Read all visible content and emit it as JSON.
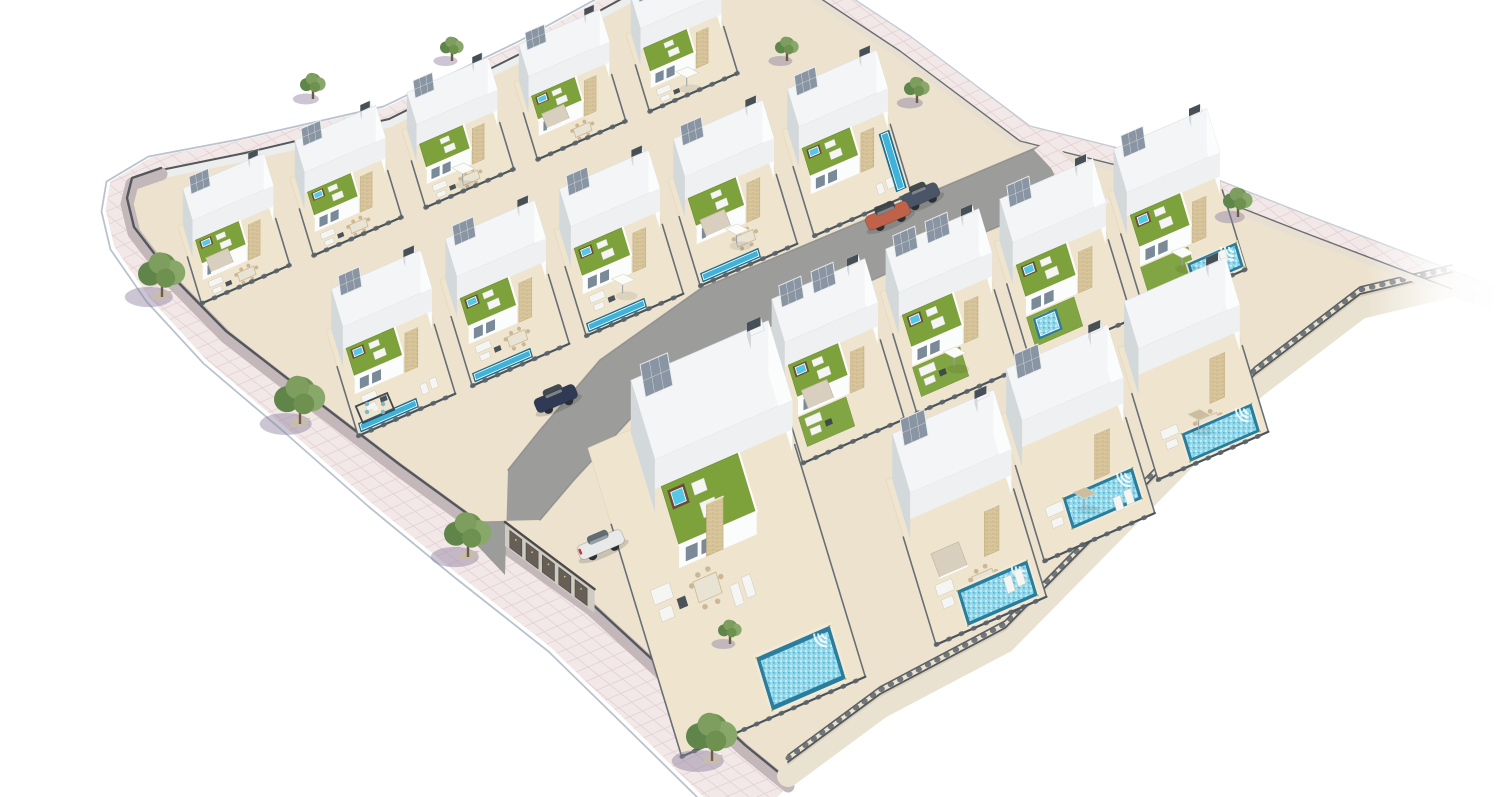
{
  "meta": {
    "scene_type": "aerial 3D architectural render of a residential villa development with rooftop gardens and pools"
  },
  "palette": {
    "bg": "#ffffff",
    "sidewalk": "#f3e8e8",
    "sidewalkLine": "#dcc6cb",
    "sidewalkEdge": "#b9c3cd",
    "curb": "#ffffff",
    "siteBase": "#ece2cd",
    "wallPink": "#c3b7ba",
    "wallWhite": "#eceded",
    "wallCream": "#eae2d0",
    "wallCap": "#54585c",
    "road": "#9c9c9a",
    "roadEdge": "#8a8a88",
    "plot": "#efe5cf",
    "plotLine": "#e2d6ba",
    "roof": "#f3f5f6",
    "faceBright": "#fbfcfc",
    "faceLight": "#eef0f1",
    "faceShade": "#d3d8db",
    "faceDark": "#c6cbcf",
    "glass": "#7a8a98",
    "door": "#5e6569",
    "stone": "#d8c69c",
    "stoneLine": "#c2aa7c",
    "grass": "#7da23c",
    "grassDark": "#688c2f",
    "jacuzziDeck": "#6a4e37",
    "jacuzziWater": "#56c8e6",
    "poolRim": "#2a7d9c",
    "poolWater": "#8fd6e8",
    "lapWater": "#3fb2d9",
    "lapRim": "#1e6e8e",
    "poolLight": "#c9a84c",
    "fence": "#4a545c",
    "fence2": "#5a636b",
    "solar": "#8a95a3",
    "solarFrame": "#e9edf0",
    "awning": "#d9cfbf",
    "awningEdge": "#c4b8a4",
    "furnWhite": "#f5f5f3",
    "furnBeige": "#cbb795",
    "furnDark": "#39434b",
    "cushTeal": "#7fb4c9",
    "treeA": "#7d9e5f",
    "treeB": "#6e9150",
    "treeC": "#87a869",
    "treeD": "#5f854a",
    "trunk": "#6d5b45",
    "treeShadow": "#8c7fa0",
    "treeBase": "#c9bdab",
    "carOrange": "#c0614a",
    "carBlue": "#2f3a55",
    "carWhite": "#e8e9e9",
    "carGray": "#4a5568",
    "carGlass": "#3a4148",
    "tailLight": "#c03b30",
    "garageWall": "#cfcac2",
    "garageDoor": "#665f58",
    "garageDoorEdge": "#4e4a45"
  },
  "scene": {
    "canvas": {
      "width": 1500,
      "height": 797
    },
    "axes": {
      "u": [
        0.92,
        -0.4
      ],
      "v": [
        0.29,
        0.955
      ]
    },
    "sidewalk_left_outer": [
      [
        648,
        -30
      ],
      [
        520,
        40
      ],
      [
        385,
        105
      ],
      [
        240,
        138
      ],
      [
        150,
        155
      ],
      [
        108,
        180
      ],
      [
        103,
        210
      ],
      [
        112,
        248
      ],
      [
        148,
        300
      ],
      [
        205,
        362
      ],
      [
        285,
        430
      ],
      [
        370,
        505
      ],
      [
        455,
        575
      ],
      [
        550,
        650
      ],
      [
        635,
        733
      ],
      [
        700,
        797
      ],
      [
        742,
        834
      ]
    ],
    "sidewalk_left_inner": [
      [
        656,
        -16
      ],
      [
        528,
        54
      ],
      [
        389,
        123
      ],
      [
        245,
        157
      ],
      [
        161,
        174
      ],
      [
        132,
        184
      ],
      [
        127,
        204
      ],
      [
        134,
        233
      ],
      [
        170,
        280
      ],
      [
        226,
        337
      ],
      [
        310,
        402
      ],
      [
        399,
        470
      ],
      [
        487,
        534
      ],
      [
        591,
        609
      ],
      [
        678,
        689
      ],
      [
        745,
        751
      ],
      [
        788,
        786
      ]
    ],
    "bottomright_wall": [
      [
        788,
        786
      ],
      [
        880,
        718
      ],
      [
        1005,
        652
      ],
      [
        1130,
        525
      ],
      [
        1255,
        398
      ],
      [
        1360,
        318
      ],
      [
        1452,
        296
      ]
    ],
    "topright_edge": [
      [
        770,
        -28
      ],
      [
        900,
        58
      ],
      [
        1020,
        148
      ],
      [
        1160,
        183
      ],
      [
        1300,
        238
      ],
      [
        1452,
        296
      ],
      [
        1540,
        330
      ]
    ],
    "topright_sidewalk_offset": [
      10,
      -22
    ],
    "road_upper": [
      [
        1040,
        146
      ],
      [
        860,
        222
      ],
      [
        700,
        289
      ],
      [
        600,
        360
      ],
      [
        540,
        430
      ],
      [
        508,
        470
      ]
    ],
    "road_lower": [
      [
        1066,
        198
      ],
      [
        886,
        274
      ],
      [
        731,
        344
      ],
      [
        634,
        415
      ],
      [
        574,
        480
      ],
      [
        540,
        520
      ]
    ],
    "road_mouth": [
      [
        508,
        470
      ],
      [
        540,
        520
      ],
      [
        505,
        575
      ],
      [
        455,
        522
      ]
    ],
    "crosswalk": [
      [
        1034,
        150
      ],
      [
        1094,
        214
      ],
      [
        1110,
        202
      ],
      [
        1050,
        138
      ]
    ],
    "garages": {
      "start": [
        505,
        546
      ],
      "dir": [
        0.8,
        0.6
      ],
      "length": 112,
      "doors": 5,
      "doorW": 15,
      "doorH": 17,
      "wallH": 24
    },
    "pergola": {
      "x": 375,
      "y": 408
    },
    "villas": [
      {
        "id": "A1",
        "o": [
          178,
          226
        ],
        "s": 0.8,
        "vs": 0.78,
        "d": 130,
        "f": [
          "awning",
          "dining",
          "sofa",
          "roofGarden",
          "jacuzzi",
          "solar",
          "stone"
        ]
      },
      {
        "id": "A2",
        "o": [
          290,
          178
        ],
        "s": 0.8,
        "vs": 0.78,
        "d": 130,
        "f": [
          "roofGarden",
          "jacuzzi",
          "solar",
          "stone",
          "sofa",
          "dining"
        ]
      },
      {
        "id": "A3",
        "o": [
          402,
          130
        ],
        "s": 0.8,
        "vs": 0.78,
        "d": 130,
        "f": [
          "umbrella",
          "roofGarden",
          "solar",
          "stone",
          "sofa",
          "dining"
        ]
      },
      {
        "id": "A4",
        "o": [
          514,
          82
        ],
        "s": 0.8,
        "vs": 0.78,
        "d": 130,
        "f": [
          "awning",
          "roofGarden",
          "jacuzzi",
          "solar",
          "stone",
          "dining"
        ]
      },
      {
        "id": "A5",
        "o": [
          626,
          34
        ],
        "s": 0.8,
        "vs": 0.78,
        "d": 130,
        "f": [
          "umbrella",
          "roofGarden",
          "solar",
          "stone",
          "sofa"
        ]
      },
      {
        "id": "B1",
        "o": [
          326,
          330
        ],
        "s": 0.88,
        "vs": 0.84,
        "f": [
          "roofGarden",
          "jacuzzi",
          "solar",
          "stone",
          "lapPoolU",
          "sofa",
          "loungers"
        ]
      },
      {
        "id": "B2",
        "o": [
          440,
          280
        ],
        "s": 0.88,
        "vs": 0.84,
        "f": [
          "roofGarden",
          "jacuzzi",
          "solar",
          "stone",
          "lapPoolU",
          "sofa",
          "dining"
        ]
      },
      {
        "id": "B3",
        "o": [
          554,
          230
        ],
        "s": 0.88,
        "vs": 0.84,
        "f": [
          "umbrella",
          "roofGarden",
          "jacuzzi",
          "solar",
          "stone",
          "lapPoolU",
          "sofa"
        ]
      },
      {
        "id": "B4",
        "o": [
          668,
          180
        ],
        "s": 0.88,
        "vs": 0.84,
        "f": [
          "awning",
          "umbrella",
          "roofGarden",
          "solar",
          "stone",
          "lapPoolU",
          "dining"
        ]
      },
      {
        "id": "B5",
        "o": [
          782,
          130
        ],
        "s": 0.88,
        "vs": 0.84,
        "f": [
          "roofGarden",
          "jacuzzi",
          "solar",
          "stone",
          "lapPoolV",
          "loungers"
        ]
      },
      {
        "id": "D1",
        "o": [
          766,
          342
        ],
        "s": 0.92,
        "vs": 0.92,
        "f": [
          "solar2",
          "roofGarden",
          "jacuzzi",
          "stone",
          "grass",
          "sofa",
          "awning"
        ]
      },
      {
        "id": "D2",
        "o": [
          880,
          292
        ],
        "s": 0.92,
        "vs": 0.92,
        "f": [
          "solar2",
          "roofGarden",
          "jacuzzi",
          "stone",
          "grass",
          "umbrella",
          "sofa"
        ]
      },
      {
        "id": "D3",
        "o": [
          994,
          242
        ],
        "s": 0.92,
        "vs": 0.92,
        "f": [
          "solar",
          "roofGarden",
          "jacuzzi",
          "stone",
          "grass",
          "smallPool",
          "sofa"
        ]
      },
      {
        "id": "D4",
        "o": [
          1108,
          192
        ],
        "s": 0.92,
        "vs": 0.92,
        "f": [
          "solar",
          "roofGarden",
          "jacuzzi",
          "stone",
          "grass",
          "umbrella",
          "bigPool",
          "loungers"
        ],
        "pool": [
          60,
          116,
          118,
          146
        ]
      },
      {
        "id": "E3",
        "o": [
          1118,
          348
        ],
        "s": 1.0,
        "vs": 0.92,
        "f": [
          "bigPool",
          "dining",
          "sofa",
          "stone",
          "umbrellaTan"
        ]
      },
      {
        "id": "E2",
        "o": [
          1000,
          415
        ],
        "s": 1.0,
        "vs": 1.02,
        "f": [
          "bigPool",
          "sofa",
          "loungers",
          "stone",
          "umbrellaTan",
          "solar"
        ],
        "pool": [
          36,
          100,
          112,
          132
        ]
      },
      {
        "id": "C0",
        "o": [
          588,
          448
        ],
        "s": 1.14,
        "vs": 1.35,
        "w": 175,
        "d": 210,
        "f": [
          "roofGardenBig",
          "jacuzzi",
          "solar",
          "stone",
          "bigPool",
          "dining",
          "sofa",
          "loungers"
        ],
        "pool": [
          88,
          170,
          158,
          206
        ]
      },
      {
        "id": "E1",
        "o": [
          886,
          480
        ],
        "s": 1.0,
        "vs": 1.15,
        "f": [
          "bigPool",
          "sofa",
          "dining",
          "loungers",
          "stone",
          "awning",
          "solar"
        ]
      }
    ],
    "trees": [
      {
        "x": 162,
        "y": 293,
        "r": 24,
        "street": true
      },
      {
        "x": 300,
        "y": 420,
        "r": 26,
        "street": true
      },
      {
        "x": 468,
        "y": 553,
        "r": 24,
        "street": true
      },
      {
        "x": 712,
        "y": 757,
        "r": 26,
        "street": true
      },
      {
        "x": 313,
        "y": 95,
        "r": 13
      },
      {
        "x": 452,
        "y": 57,
        "r": 12
      },
      {
        "x": 787,
        "y": 57,
        "r": 12
      },
      {
        "x": 917,
        "y": 99,
        "r": 13
      },
      {
        "x": 1238,
        "y": 213,
        "r": 15
      },
      {
        "x": 730,
        "y": 640,
        "r": 12
      }
    ],
    "cars": [
      {
        "name": "car-gray",
        "x": 921,
        "y": 196,
        "len": 38,
        "color": "carGray",
        "angle": -23
      },
      {
        "name": "car-orange",
        "x": 888,
        "y": 216,
        "len": 46,
        "color": "carOrange",
        "angle": -23
      },
      {
        "name": "car-blue",
        "x": 556,
        "y": 399,
        "len": 44,
        "color": "carBlue",
        "angle": -23
      },
      {
        "name": "car-white",
        "x": 601,
        "y": 545,
        "len": 48,
        "color": "carWhite",
        "angle": -23,
        "tail": true
      }
    ],
    "fadeRight": {
      "x": 1365,
      "w": 135
    }
  }
}
